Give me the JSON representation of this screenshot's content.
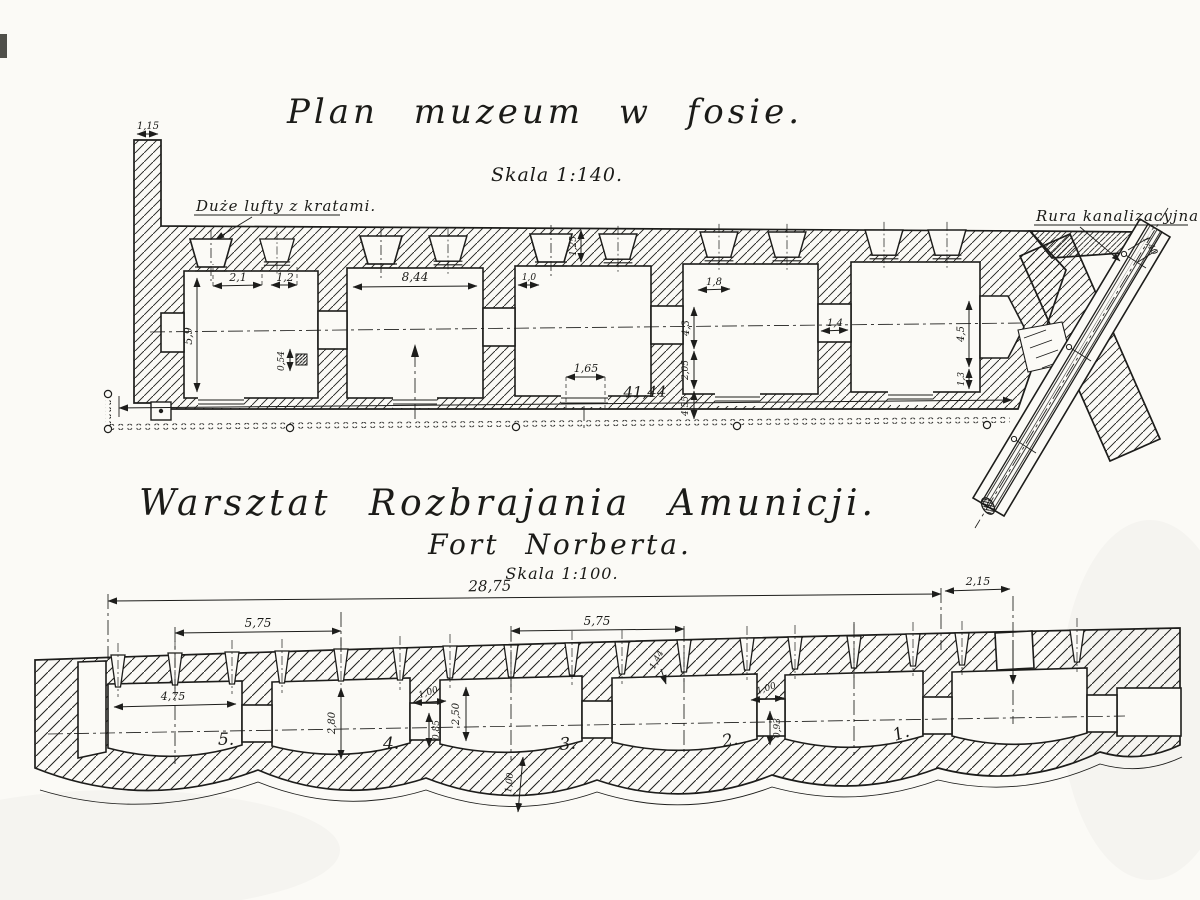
{
  "canvas": {
    "paper": "#fbfaf6",
    "ink": "#1d1d1b"
  },
  "top_plan": {
    "title": "Plan muzeum w fosie.",
    "scale": "Skala 1:140.",
    "vents_label": "Duże lufty z kratami.",
    "pipe_label": "Rura kanalizacyjna.",
    "dim_wall_top": "1,15",
    "dim_room1_a": "2,1",
    "dim_room1_b": "1,2",
    "dim_room1_h": "5,9",
    "dim_niche": "0,54",
    "dim_room2_w": "8,44",
    "dim_room3_t": "1,0",
    "dim_vent_h": "1,25",
    "dim_door": "1,65",
    "dim_wall34_a": "4,3",
    "dim_wall34_b": "2,05",
    "dim_wall34_c": "4,55",
    "dim_room4_t": "1,8",
    "dim_pass45": "1,4",
    "dim_room5_a": "4,5",
    "dim_room5_b": "1,3",
    "dim_total": "41,44",
    "dim_pipe": "1,40"
  },
  "bottom_plan": {
    "title": "Warsztat Rozbrajania Amunicji.",
    "subtitle": "Fort Norberta.",
    "scale": "Skala 1:100.",
    "dim_total": "28,75",
    "dim_entry": "2,15",
    "dim_span_a": "5,75",
    "dim_span_b": "5,75",
    "dim_room5_w": "4,75",
    "dim_room4_h": "2,80",
    "dim_room3_h": "2,50",
    "dim_pass43_w": "1,00",
    "dim_pass43_h": "0,85",
    "dim_wall2": "1,44",
    "dim_pass21_w": "1,00",
    "dim_pass21_h": "0,93",
    "dim_floor": "1,00",
    "room_numbers": [
      "5.",
      "4.",
      "3.",
      "2.",
      "1."
    ]
  }
}
